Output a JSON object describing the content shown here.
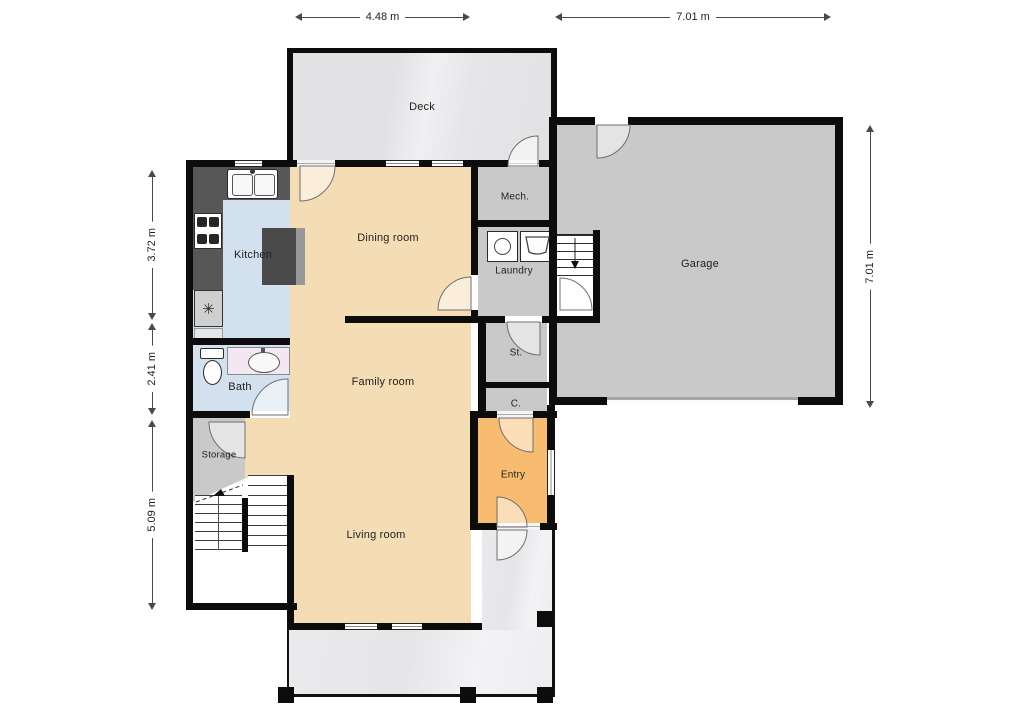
{
  "rooms": {
    "deck": "Deck",
    "mech": "Mech.",
    "laundry": "Laundry",
    "kitchen": "Kitchen",
    "dining": "Dining room",
    "garage": "Garage",
    "family": "Family room",
    "bath": "Bath",
    "st": "St.",
    "c": "C.",
    "storage": "Storage",
    "entry": "Entry",
    "living": "Living room"
  },
  "dimensions": {
    "top_left": "4.48 m",
    "top_right": "7.01 m",
    "left_upper": "3.72 m",
    "left_middle": "2.41 m",
    "left_lower": "5.09 m",
    "right_side": "7.01 m"
  },
  "fixtures": {
    "fridge_symbol": "✳"
  },
  "colors": {
    "wall": "#0c0c0c",
    "floor_tan": "#f4ddb4",
    "floor_blue": "#d3e0ed",
    "floor_orange": "#f7bc70",
    "floor_gray": "#c9c9c9",
    "floor_deck": "#e5e5e7",
    "counter_dark": "#575757"
  }
}
